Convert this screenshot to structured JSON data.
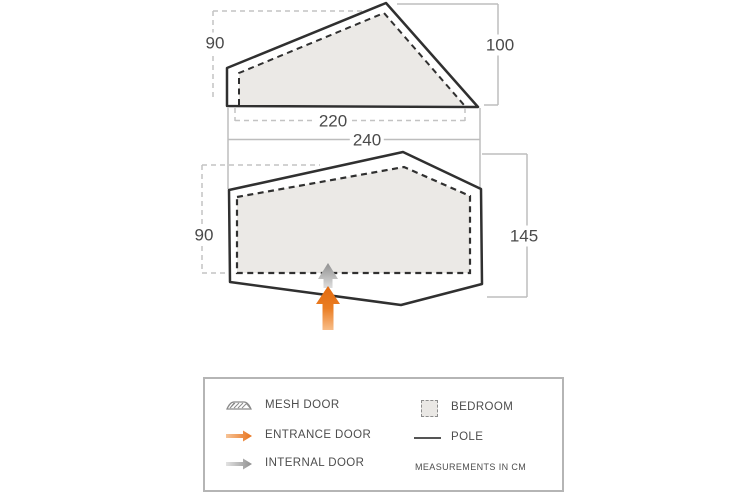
{
  "diagram": {
    "type": "tent-floorplan",
    "views": {
      "side_elevation": {
        "dim_rear_height": "90",
        "dim_peak_height": "100",
        "dim_inner_length": "220",
        "dim_outer_length": "240"
      },
      "floor_plan": {
        "dim_rear_width": "90",
        "dim_depth": "145"
      }
    },
    "legend": {
      "items": [
        {
          "icon": "mesh-door-icon",
          "label": "MESH DOOR"
        },
        {
          "icon": "entrance-door-arrow-icon",
          "label": "ENTRANCE DOOR"
        },
        {
          "icon": "internal-door-arrow-icon",
          "label": "INTERNAL DOOR"
        },
        {
          "icon": "bedroom-swatch-icon",
          "label": "BEDROOM"
        },
        {
          "icon": "pole-line-icon",
          "label": "POLE"
        }
      ],
      "note": "MEASUREMENTS IN CM"
    },
    "colors": {
      "outline": "#303030",
      "bedroom_fill": "#ebe9e6",
      "dimension_line": "#bdbdbd",
      "entrance_arrow": "#e8731d",
      "internal_arrow": "#979797",
      "text": "#4a4a4a"
    }
  }
}
